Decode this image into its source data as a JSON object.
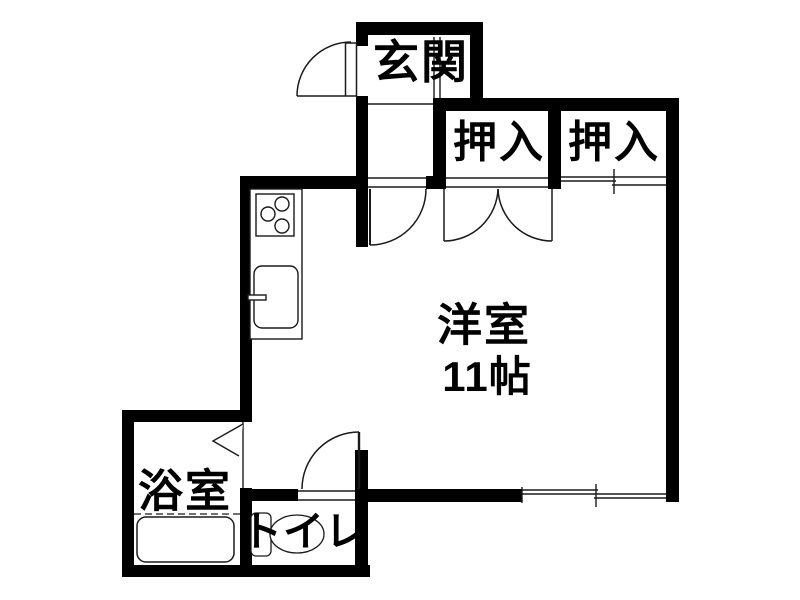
{
  "plan": {
    "title": "apartment-floorplan",
    "rooms": {
      "genkan": {
        "label": "玄関"
      },
      "closet_left": {
        "label": "押入"
      },
      "closet_right": {
        "label": "押入"
      },
      "main_room": {
        "label": "洋室",
        "size": "11帖"
      },
      "bathroom": {
        "label": "浴室"
      },
      "toilet": {
        "label": "トイレ"
      }
    },
    "fixtures": {
      "stove": "stove-burners-icon",
      "sink": "kitchen-sink-icon",
      "bathtub": "bathtub-icon",
      "toilet_bowl": "toilet-bowl-icon"
    },
    "doors": {
      "entrance": "swing-door",
      "main_room": "swing-door",
      "closet_left": "double-swing-door",
      "closet_right": "sliding-door",
      "toilet": "swing-door",
      "bathroom": "folding-door",
      "south_window": "sliding-window"
    },
    "colors": {
      "wall": "#000000",
      "line": "#1a1a1a",
      "background": "#ffffff"
    }
  }
}
